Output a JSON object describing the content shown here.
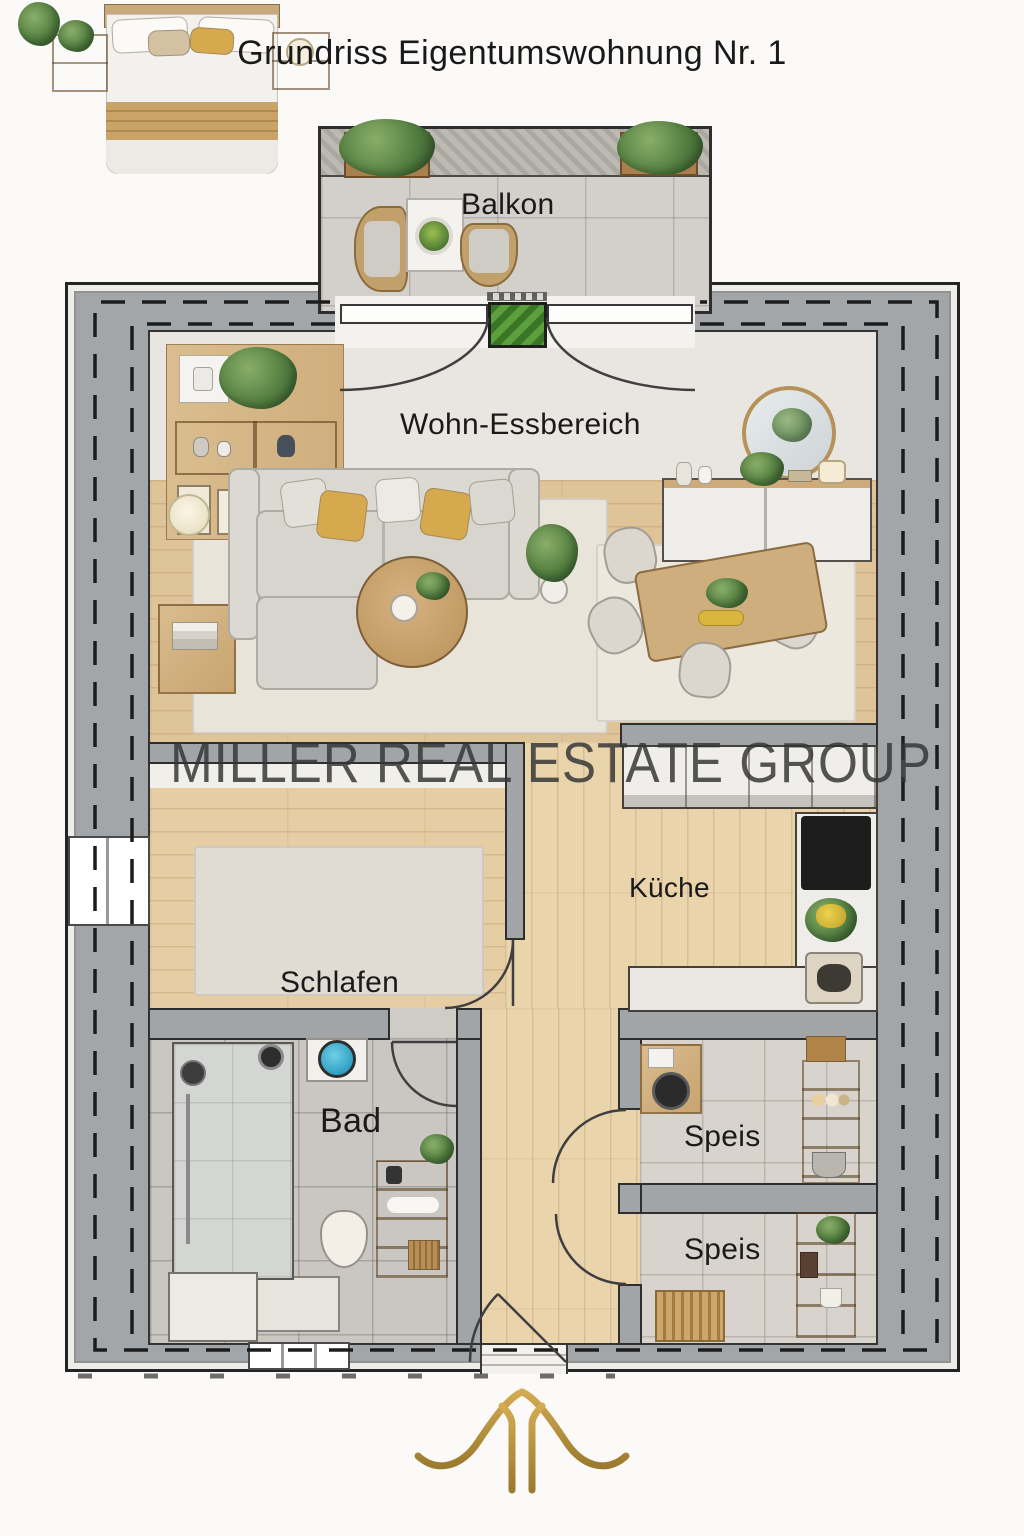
{
  "title": "Grundriss Eigentumswohnung Nr. 1",
  "watermark": "MILLER REAL ESTATE GROUP",
  "rooms": {
    "balcony": {
      "label": "Balkon"
    },
    "living_dining": {
      "label": "Wohn-Essbereich"
    },
    "kitchen": {
      "label": "Küche"
    },
    "bedroom": {
      "label": "Schlafen"
    },
    "bathroom": {
      "label": "Bad"
    },
    "pantry_1": {
      "label": "Speis"
    },
    "pantry_2": {
      "label": "Speis"
    }
  },
  "colors": {
    "wall_gray": "#a3a6a8",
    "wood_floor": "#dfc49a",
    "tile_gray": "#d3d0cb",
    "accent_gold": "#b8933f",
    "pillow_yellow": "#d7a94e",
    "doormat_green": "#5ba03c",
    "watermark_gray": "#343434",
    "title_black": "#191919"
  },
  "brand": {
    "logo_icon": "gold-gable-monogram"
  }
}
